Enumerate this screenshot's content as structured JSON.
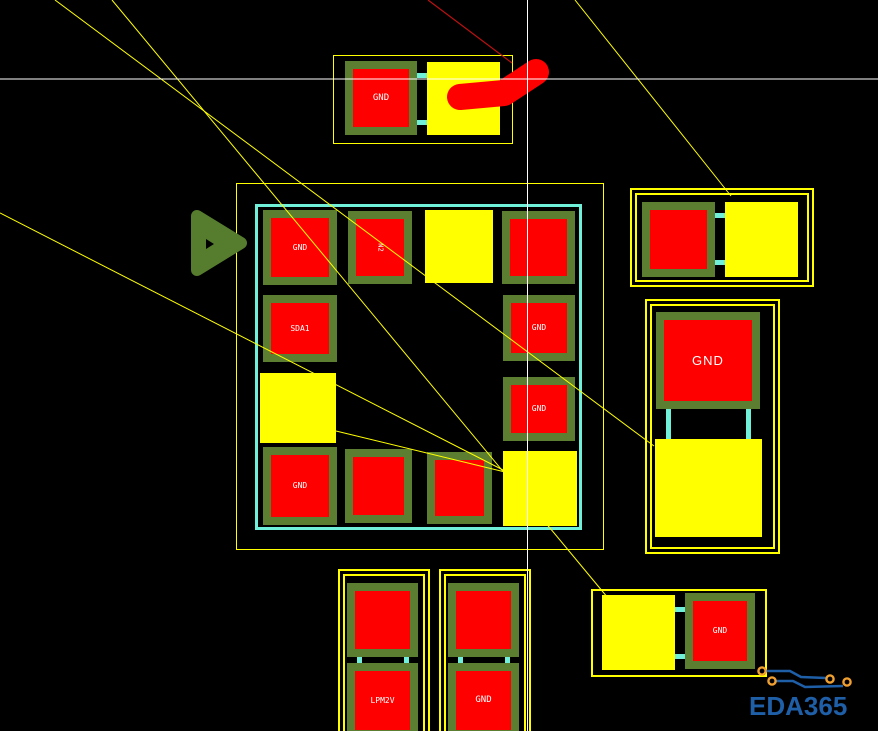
{
  "watermark": {
    "text": "EDA365"
  },
  "colors": {
    "background": "#000000",
    "pad_red": "#ff0000",
    "pad_border_green": "#5c7e30",
    "pad_yellow": "#ffff00",
    "courtyard_outline": "#ffff00",
    "assembly_cyan": "#70f0d8",
    "ratsnest_yellow": "#ffff00",
    "crosshair_white": "#ffffff",
    "route_red": "#ff0000",
    "direction_marker_green": "#567d2e",
    "logo_blue": "#1e5fa8",
    "logo_orange": "#f0a030"
  },
  "components": {
    "top_connector": {
      "pads": [
        {
          "label": "GND"
        },
        {
          "label": ""
        }
      ]
    },
    "center_ic": {
      "pads": [
        {
          "label": "GND"
        },
        {
          "label": "N2"
        },
        {
          "label": ""
        },
        {
          "label": ""
        },
        {
          "label": "SDA1"
        },
        {
          "label": ""
        },
        {
          "label": "GND"
        },
        {
          "label": "GND"
        },
        {
          "label": "GND"
        },
        {
          "label": ""
        },
        {
          "label": ""
        },
        {
          "label": ""
        }
      ]
    },
    "right_top_connector": {
      "pads": [
        {
          "label": ""
        },
        {
          "label": ""
        }
      ]
    },
    "right_large_connector": {
      "pads": [
        {
          "label": "GND"
        },
        {
          "label": ""
        }
      ]
    },
    "bottom_connector_a": {
      "pads": [
        {
          "label": ""
        },
        {
          "label": "LPM2V"
        }
      ]
    },
    "bottom_connector_b": {
      "pads": [
        {
          "label": ""
        },
        {
          "label": "GND"
        }
      ]
    },
    "bottom_right_connector": {
      "pads": [
        {
          "label": ""
        },
        {
          "label": "GND"
        }
      ]
    }
  }
}
